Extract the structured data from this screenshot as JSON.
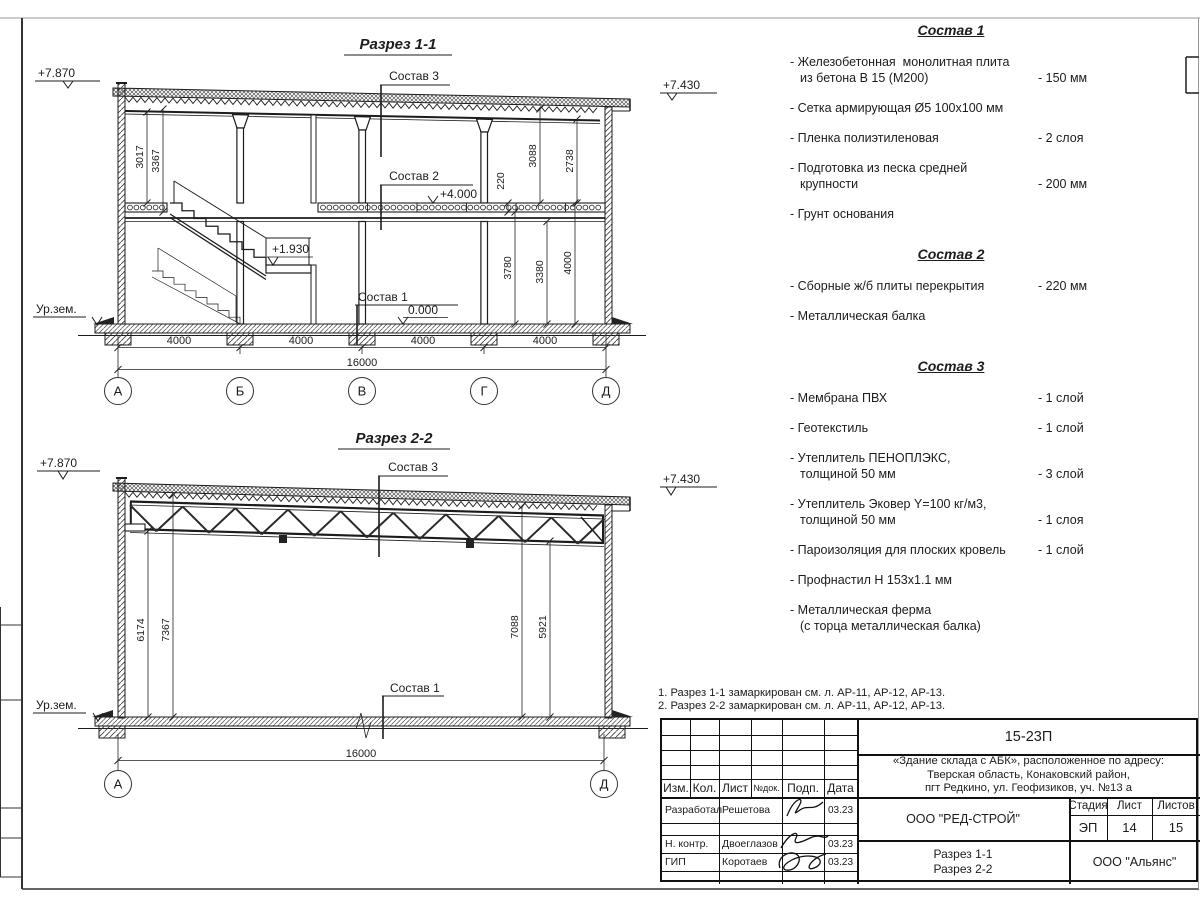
{
  "section1": {
    "title": "Разрез 1-1",
    "elevations": {
      "left": "+7.870",
      "right": "+7.430",
      "mid": "+4.000",
      "landing": "+1.930",
      "zero": "0.000"
    },
    "ground": "Ур.зем.",
    "callouts": {
      "c1": "Состав 1",
      "c2": "Состав 2",
      "c3": "Состав 3"
    },
    "dims": {
      "left": [
        "3017",
        "3367"
      ],
      "upper": [
        "220",
        "3088",
        "2738"
      ],
      "lower": [
        "3780",
        "3380",
        "4000"
      ],
      "bottom": [
        "4000",
        "4000",
        "4000",
        "4000"
      ],
      "total": "16000"
    },
    "axes": [
      "А",
      "Б",
      "В",
      "Г",
      "Д"
    ]
  },
  "section2": {
    "title": "Разрез 2-2",
    "elevations": {
      "left": "+7.870",
      "right": "+7.430"
    },
    "ground": "Ур.зем.",
    "callouts": {
      "c1": "Состав 1",
      "c3": "Состав 3"
    },
    "dims": {
      "left": [
        "6174",
        "7367"
      ],
      "right": [
        "7088",
        "5921"
      ],
      "total": "16000"
    },
    "axes": [
      "А",
      "Д"
    ]
  },
  "compositions": [
    {
      "title": "Состав 1",
      "items": [
        {
          "text": "- Железобетонная  монолитная плита\nиз бетона В 15 (М200)",
          "value": "- 150 мм"
        },
        {
          "text": "- Сетка армирующая Ø5 100х100 мм",
          "value": ""
        },
        {
          "text": "- Пленка полиэтиленовая",
          "value": "-  2 слоя"
        },
        {
          "text": "- Подготовка из песка средней\nкрупности",
          "value": "- 200 мм"
        },
        {
          "text": "- Грунт основания",
          "value": ""
        }
      ]
    },
    {
      "title": "Состав 2",
      "items": [
        {
          "text": "- Сборные ж/б плиты перекрытия",
          "value": "- 220 мм"
        },
        {
          "text": "- Металлическая балка",
          "value": ""
        }
      ]
    },
    {
      "title": "Состав 3",
      "items": [
        {
          "text": "- Мембрана ПВХ",
          "value": "- 1 слой"
        },
        {
          "text": "- Геотекстиль",
          "value": "- 1 слой"
        },
        {
          "text": "- Утеплитель ПЕНОПЛЭКС,\nтолщиной 50 мм",
          "value": "- 3 слой"
        },
        {
          "text": "- Утеплитель Эковер Y=100 кг/м3,\nтолщиной 50 мм",
          "value": "- 1 слоя"
        },
        {
          "text": "- Пароизоляция для плоских кровель",
          "value": "- 1 слой"
        },
        {
          "text": "- Профнастил Н 153х1.1 мм",
          "value": ""
        },
        {
          "text": "- Металлическая ферма\n(с торца металлическая балка)",
          "value": ""
        }
      ]
    }
  ],
  "notes": "1. Разрез 1-1 замаркирован см. л. АР-11, АР-12, АР-13.\n2. Разрез 2-2 замаркирован см. л. АР-11, АР-12, АР-13.",
  "titleblock": {
    "doc_number": "15-23П",
    "object": "«Здание склада с АБК», расположенное по адресу:\nТверская область, Конаковский район,\nпгт Редкино, ул. Геофизиков, уч. №13 а",
    "cols": {
      "izm": "Изм.",
      "kol": "Кол.",
      "list": "Лист",
      "ndok": "№док.",
      "podp": "Подп.",
      "data": "Дата"
    },
    "rows": [
      {
        "role": "Разработал",
        "name": "Решетова",
        "date": "03.23"
      },
      {
        "role": "Н. контр.",
        "name": "Двоеглазов",
        "date": "03.23"
      },
      {
        "role": "ГИП",
        "name": "Коротаев",
        "date": "03.23"
      }
    ],
    "company": "ООО \"РЕД-СТРОЙ\"",
    "stage_label": "Стадия",
    "sheet_label": "Лист",
    "sheets_label": "Листов",
    "stage": "ЭП",
    "sheet_num": "14",
    "sheets_total": "15",
    "titles": "Разрез 1-1\nРазрез 2-2",
    "contractor": "ООО \"Альянс\""
  }
}
